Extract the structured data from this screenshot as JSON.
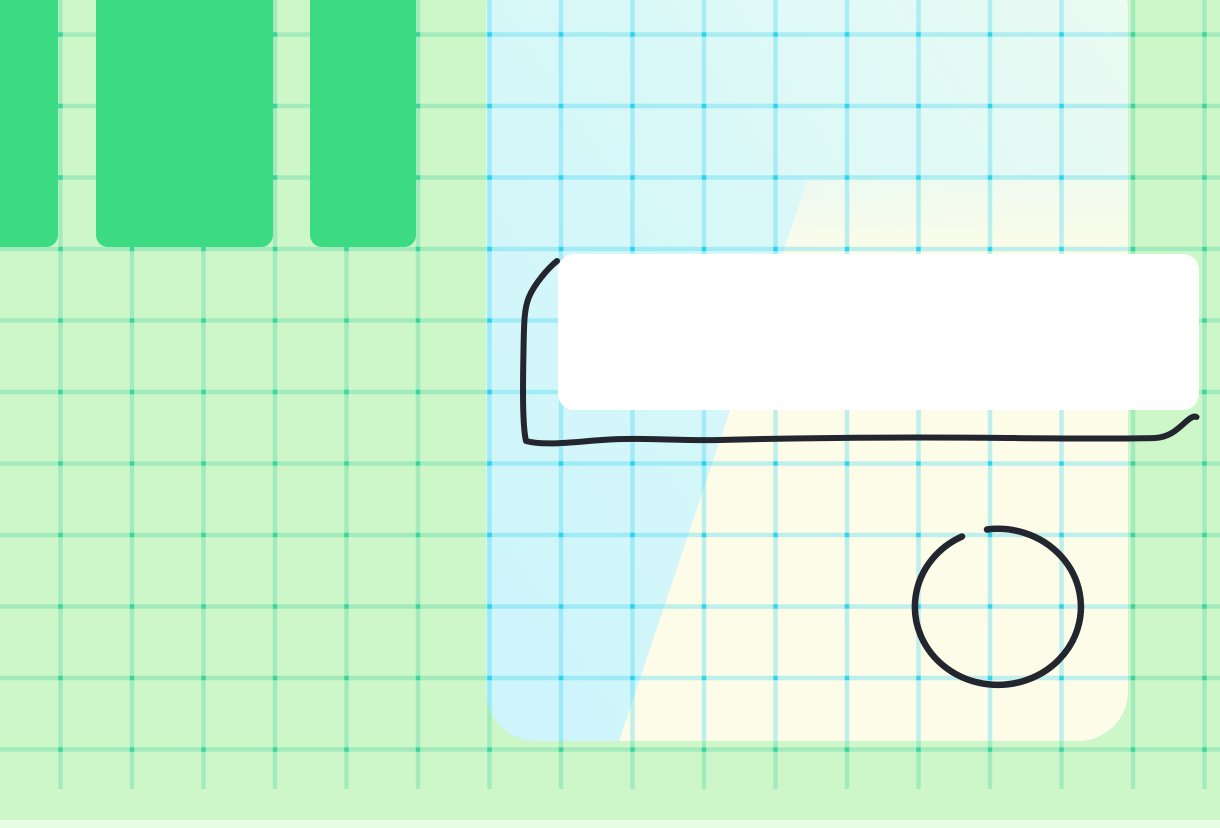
{
  "app": {
    "name": "whiteboard-canvas",
    "title": "Canvas"
  },
  "canvas": {
    "width": 1220,
    "height": 828,
    "background": {
      "color": "#cdf6c9",
      "grid": {
        "spacing": 71.5,
        "line_width": 4.5,
        "offset_x": 58.25,
        "offset_y": 32.25,
        "line_color": "rgba(47,207,150,0.27)",
        "dot_color": "rgba(32,206,148,0.72)",
        "extent_width": 1220,
        "extent_height": 789
      },
      "bottom_strip": {
        "color": "rgba(255,255,255,0.55)",
        "y": 820,
        "height": 8
      }
    },
    "shapes": {
      "green_cards": [
        {
          "x": -22,
          "y": -24,
          "width": 80,
          "height": 271,
          "rx": 12,
          "color": "#3cda81"
        },
        {
          "x": 96,
          "y": -24,
          "width": 177,
          "height": 271,
          "rx": 12,
          "color": "#3cda81"
        },
        {
          "x": 310,
          "y": -24,
          "width": 106,
          "height": 271,
          "rx": 12,
          "color": "#3cda81"
        }
      ],
      "frame": {
        "x": 486,
        "y": -40,
        "width": 642,
        "height": 781,
        "rx": 50,
        "gradient": {
          "from": "#cdf5fb",
          "mid": "#d9f8f8",
          "to": "#ebfbf2"
        }
      },
      "cream_overlay": {
        "points": "808,178 1128,178 1128,741 619,741",
        "color": "#fcfce9",
        "fade_top_color": "rgba(252,252,233,0.45)"
      },
      "frame_grid": {
        "line_color": "rgba(34,205,238,0.28)",
        "dot_color": "rgba(0,205,235,0.65)"
      },
      "white_card": {
        "x": 558,
        "y": 254,
        "width": 641,
        "height": 156,
        "rx": 16,
        "color": "#ffffff"
      },
      "ink": {
        "color": "#23262e",
        "bracket": {
          "path": "M 557 261 C 547 269 534 285 529 297 C 524 309 524 324 523.5 350 C 523 378 522 424 526 441 C 544 446 573 442 602 440 C 641 437 676 441 719 440 C 792 438 898 437 1008 438 C 1068 438.5 1122 439 1155 438 C 1169 437.5 1178 429 1185 422.5 C 1190 418 1193.5 415.5 1196.5 417",
          "width": 6
        },
        "circle": {
          "path": "M 987 529.5 A 83 78 0 1 1 962 536.5",
          "width": 6.5
        }
      }
    }
  }
}
